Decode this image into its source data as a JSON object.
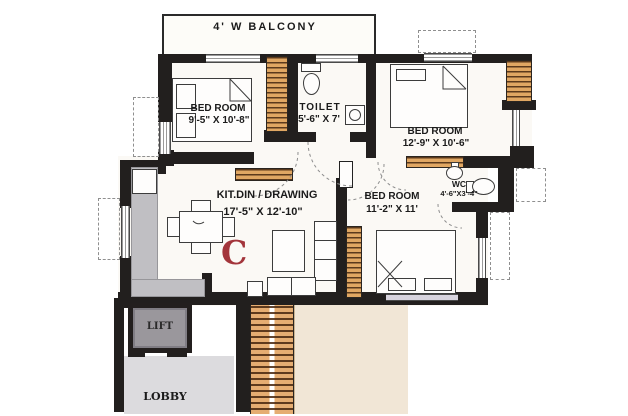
{
  "unit_letter": "C",
  "rooms": {
    "balcony": {
      "name": "4' W BALCONY"
    },
    "bedroom_top_left": {
      "name": "BED ROOM",
      "dims": "9'-5\" X 10'-8\""
    },
    "toilet": {
      "name": "TOILET",
      "dims": "5'-6\" X 7'"
    },
    "bedroom_top_right": {
      "name": "BED ROOM",
      "dims": "12'-9\" X 10'-6\""
    },
    "kitchen_dining_drawing": {
      "name": "KIT.DIN / DRAWING",
      "dims": "17'-5\" X 12'-10\""
    },
    "bedroom_right": {
      "name": "BED ROOM",
      "dims": "11'-2\" X 11'"
    },
    "wc": {
      "name": "WC",
      "dims": "4'-6\"X3'-4\""
    },
    "lift": {
      "name": "LIFT"
    },
    "lobby": {
      "name": "LOBBY"
    }
  },
  "colors": {
    "wall": "#221f1e",
    "unit_letter_red": "#a3353b",
    "wardrobe_tan": "#e0a763",
    "stair_tan": "#e5ad72",
    "counter_gray": "#c0bfc3",
    "lift_gray": "#9a979c",
    "lobby_gray": "#dcdbde",
    "adjacent_cream": "#f1e6d6",
    "floor": "#fbf9f5"
  }
}
